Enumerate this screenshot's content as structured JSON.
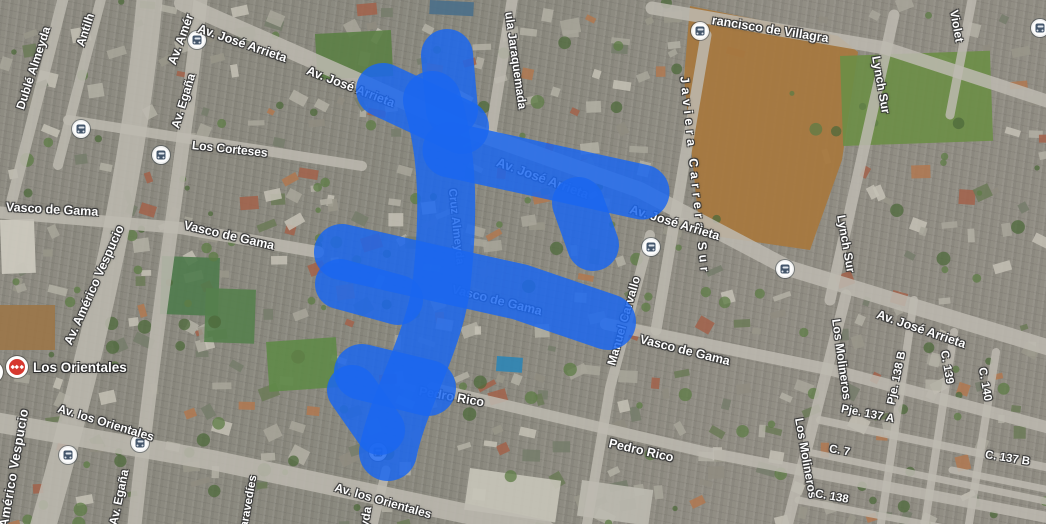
{
  "map": {
    "view_type": "satellite",
    "colors": {
      "selection_blue": "#1a66f0",
      "metro_red": "#d6382f",
      "bus_icon_slate": "#44566b",
      "label_white": "#ffffff"
    },
    "selection": {
      "description": "blue painted selection covering street network (Cruz Almeyda / Av. José Arrieta / Vasco de Gama / Pedro Rico area)",
      "color": "#1a66f0"
    },
    "street_labels": [
      {
        "text": "Dublé Almeyda",
        "x": 20,
        "y": 103,
        "rot": -72,
        "size": 12
      },
      {
        "text": "Antilh",
        "x": 80,
        "y": 40,
        "rot": -72,
        "size": 12
      },
      {
        "text": "Av. Amér",
        "x": 172,
        "y": 58,
        "rot": -70,
        "size": 12.5
      },
      {
        "text": "Av. Egaña",
        "x": 175,
        "y": 122,
        "rot": -73,
        "size": 12
      },
      {
        "text": "Av. José Arrieta",
        "x": 198,
        "y": 22,
        "rot": 19,
        "size": 12.5
      },
      {
        "text": "Los Corteses",
        "x": 192,
        "y": 139,
        "rot": 6,
        "size": 12
      },
      {
        "text": "Av. José Arrieta",
        "x": 307,
        "y": 64,
        "rot": 21,
        "size": 12.5
      },
      {
        "text": "ula Jaraquemada",
        "x": 509,
        "y": 6,
        "rot": 82,
        "size": 12
      },
      {
        "text": "Javiera Carrera Sur",
        "x": 684,
        "y": 70,
        "rot": 84,
        "size": 12.5,
        "ls": 4.5
      },
      {
        "text": "rancisco de Villagra",
        "x": 712,
        "y": 14,
        "rot": 9,
        "size": 12.5
      },
      {
        "text": "Violet",
        "x": 954,
        "y": 4,
        "rot": 80,
        "size": 12
      },
      {
        "text": "Av. Américo Vespucio",
        "x": 68,
        "y": 338,
        "rot": -66,
        "size": 12.5
      },
      {
        "text": "Américo Vespucio",
        "x": 3,
        "y": 521,
        "rot": -80,
        "size": 13,
        "ls": 0.5
      },
      {
        "text": "Av. Egaña",
        "x": 113,
        "y": 519,
        "rot": -78,
        "size": 12
      },
      {
        "text": "Vasco de Gama",
        "x": 6,
        "y": 201,
        "rot": 3,
        "size": 12.5
      },
      {
        "text": "Vasco de Gama",
        "x": 184,
        "y": 219,
        "rot": 13,
        "size": 12.5
      },
      {
        "text": "Vasco de Gama",
        "x": 452,
        "y": 283,
        "rot": 14,
        "size": 12.5
      },
      {
        "text": "Av. José Arrieta",
        "x": 497,
        "y": 155,
        "rot": 20,
        "size": 13
      },
      {
        "text": "Cruz Almeyda",
        "x": 451,
        "y": 183,
        "rot": 84,
        "size": 11.5
      },
      {
        "text": "Av. José Arrieta",
        "x": 630,
        "y": 203,
        "rot": 17,
        "size": 12.5
      },
      {
        "text": "Manuel Carvallo",
        "x": 611,
        "y": 359,
        "rot": -74,
        "size": 12
      },
      {
        "text": "Vasco de Gama",
        "x": 640,
        "y": 333,
        "rot": 14,
        "size": 12.5
      },
      {
        "text": "Lynch Sur",
        "x": 876,
        "y": 50,
        "rot": 80,
        "size": 12
      },
      {
        "text": "Lynch Sur",
        "x": 841,
        "y": 209,
        "rot": 80,
        "size": 12
      },
      {
        "text": "Los Molineros",
        "x": 836,
        "y": 313,
        "rot": 82,
        "size": 12
      },
      {
        "text": "Los Molineros",
        "x": 799,
        "y": 412,
        "rot": 80,
        "size": 12
      },
      {
        "text": "Av. José Arrieta",
        "x": 877,
        "y": 308,
        "rot": 19,
        "size": 12.5
      },
      {
        "text": "Pje. 138 B",
        "x": 892,
        "y": 399,
        "rot": -78,
        "size": 11.5
      },
      {
        "text": "C. 139",
        "x": 943,
        "y": 345,
        "rot": 80,
        "size": 11.5
      },
      {
        "text": "C. 140",
        "x": 981,
        "y": 362,
        "rot": 80,
        "size": 11.5
      },
      {
        "text": "Pje. 137 A",
        "x": 841,
        "y": 404,
        "rot": 11,
        "size": 11.5
      },
      {
        "text": "C. 7",
        "x": 829,
        "y": 444,
        "rot": 10,
        "size": 11.5
      },
      {
        "text": "C. 137 B",
        "x": 985,
        "y": 450,
        "rot": 9,
        "size": 11.5
      },
      {
        "text": "C. 138",
        "x": 815,
        "y": 489,
        "rot": 10,
        "size": 11.5
      },
      {
        "text": "Pedro Rico",
        "x": 419,
        "y": 385,
        "rot": 10,
        "size": 12.5
      },
      {
        "text": "Pedro Rico",
        "x": 609,
        "y": 437,
        "rot": 13,
        "size": 12.5
      },
      {
        "text": "Av. los Orientales",
        "x": 58,
        "y": 402,
        "rot": 17,
        "size": 12
      },
      {
        "text": "Av. los Orientales",
        "x": 335,
        "y": 481,
        "rot": 16,
        "size": 12
      },
      {
        "text": "aravedíes",
        "x": 245,
        "y": 522,
        "rot": -80,
        "size": 11.5
      },
      {
        "text": "yda",
        "x": 364,
        "y": 521,
        "rot": -80,
        "size": 12
      }
    ],
    "transit": {
      "metro_stations": [
        {
          "label": "Los Orientales",
          "x": 17,
          "y": 367,
          "label_x": 33,
          "label_y": 360
        },
        {
          "label": "",
          "x": -8,
          "y": 372,
          "label_x": 0,
          "label_y": 0
        }
      ],
      "bus_stops": [
        {
          "x": 197,
          "y": 40
        },
        {
          "x": 700,
          "y": 31
        },
        {
          "x": 1040,
          "y": 28
        },
        {
          "x": 81,
          "y": 129
        },
        {
          "x": 161,
          "y": 155
        },
        {
          "x": 651,
          "y": 247
        },
        {
          "x": 785,
          "y": 269
        },
        {
          "x": 140,
          "y": 443
        },
        {
          "x": 68,
          "y": 455
        },
        {
          "x": 378,
          "y": 452
        }
      ]
    }
  }
}
